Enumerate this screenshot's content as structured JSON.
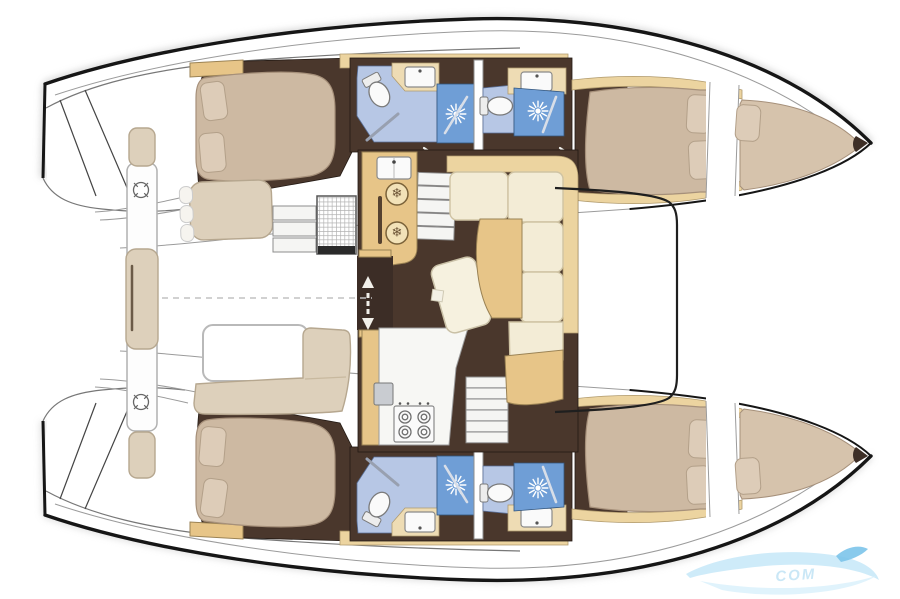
{
  "colors": {
    "background": "#ffffff",
    "hull_outline": "#161616",
    "floor_dark": "#4a372c",
    "wood": "#e7c588",
    "wood_light": "#ecd4a0",
    "counter": "#eedcb4",
    "bed": "#cdb9a2",
    "bed_light": "#d6c3ac",
    "pillow": "#ddccb8",
    "sofa": "#f3ecd6",
    "sofa_edge": "#cfc3a3",
    "bench": "#ddd0bb",
    "bath_floor": "#b7c7e5",
    "shower": "#6f9ed6",
    "fixture_white": "#fafafa",
    "steel": "#d8dee8",
    "watermark_light": "#c6e7f8",
    "watermark_mid": "#9fd4ef",
    "watermark_dark": "#7cc4ea"
  },
  "icons": {
    "snowflake": "❄"
  },
  "watermark": {
    "text": "COM"
  }
}
